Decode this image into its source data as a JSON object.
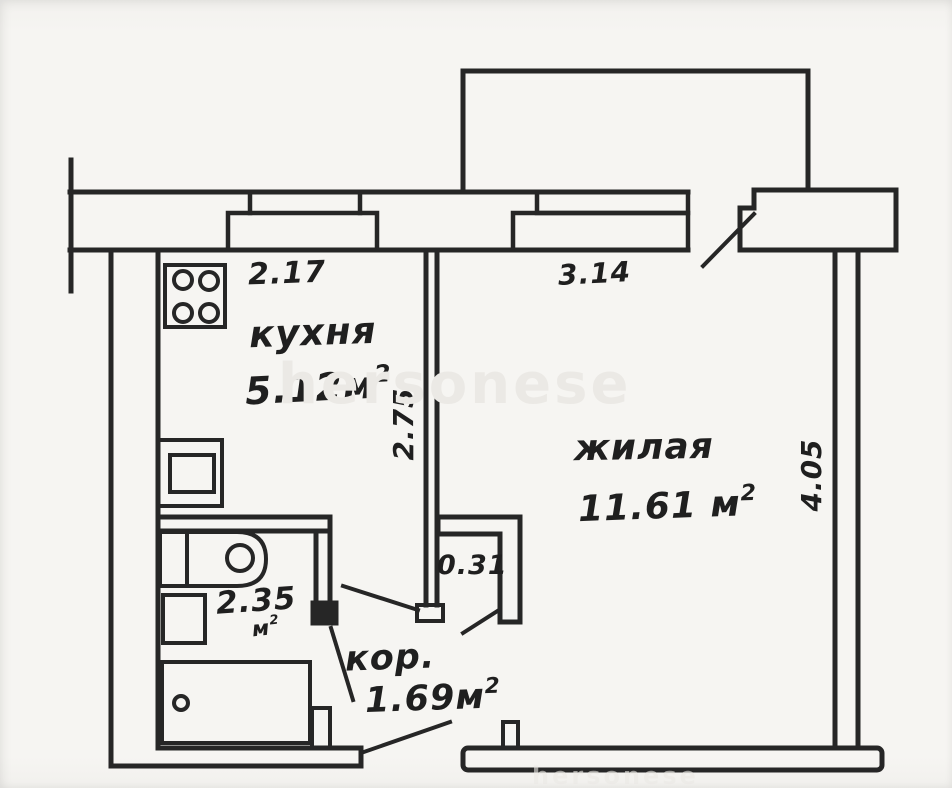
{
  "watermark": {
    "text": "hersonese"
  },
  "colors": {
    "ink": "#262626",
    "paper": "#f6f5f2",
    "watermark": "#ebe9e5"
  },
  "labels": {
    "kitchen": {
      "name": "кухня",
      "area": "5.12м",
      "area_sup": "2"
    },
    "living": {
      "name": "жилая",
      "area": "11.61 м",
      "area_sup": "2"
    },
    "corridor": {
      "name": "кор.",
      "area": "1.69м",
      "area_sup": "2"
    },
    "bathroom": {
      "area": "2.35",
      "area_unit": "м",
      "area_unit_sup": "2"
    }
  },
  "dimensions": {
    "kitchen_width": "2.17",
    "living_width": "3.14",
    "kitchen_depth": "2.75",
    "living_depth": "4.05",
    "corridor_niche": "0.31"
  }
}
